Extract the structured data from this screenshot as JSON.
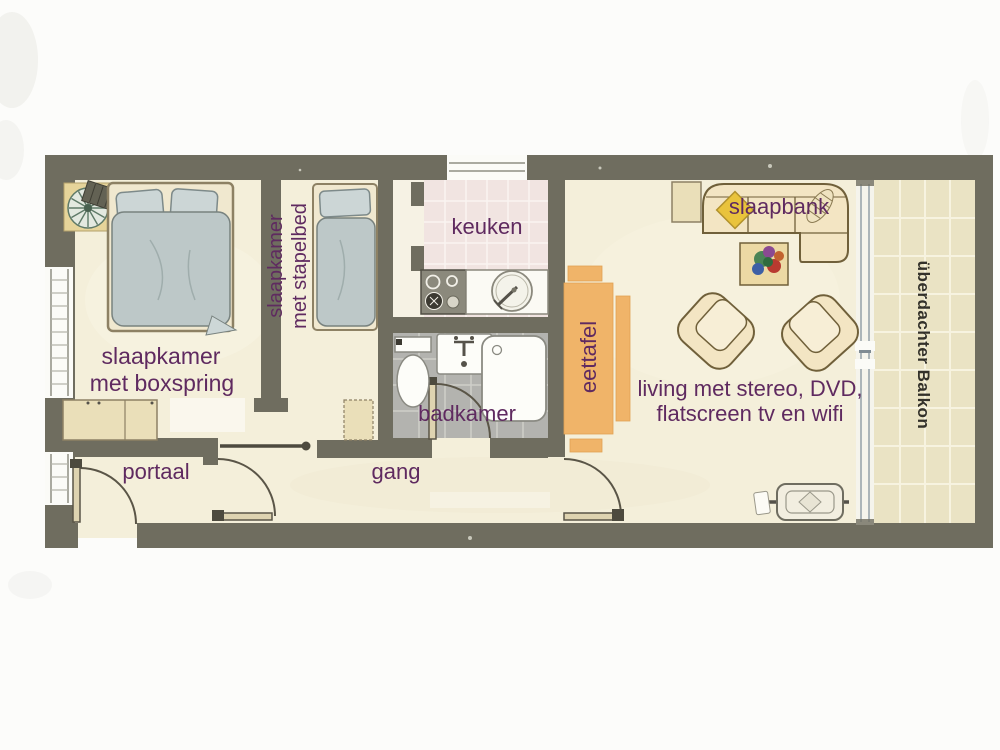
{
  "colors": {
    "wall": "#6f6d5f",
    "floor": "#f4efda",
    "kitchen_tile": "#f1e4e1",
    "bathroom_tile": "#b3b3af",
    "balcony_tile": "#eae3c4",
    "furniture_tan": "#eee1bc",
    "bed_linen": "#bdc8c8",
    "dining_orange": "#f0b469",
    "sofa_fill": "#f3e5c3",
    "label_purple": "#5f2a60",
    "balcony_label": "#33312a"
  },
  "labels": {
    "bedroom1_line1": "slaapkamer",
    "bedroom1_line2": "met boxspring",
    "bedroom2_line1": "slaapkamer",
    "bedroom2_line2": "met stapelbed",
    "kitchen": "keuken",
    "bathroom": "badkamer",
    "dining_table": "eettafel",
    "sofa": "slaapbank",
    "living_line1": "living met stereo, DVD,",
    "living_line2": "flatscreen tv en wifi",
    "hall": "portaal",
    "corridor": "gang",
    "balcony": "überdachter Balkon"
  }
}
